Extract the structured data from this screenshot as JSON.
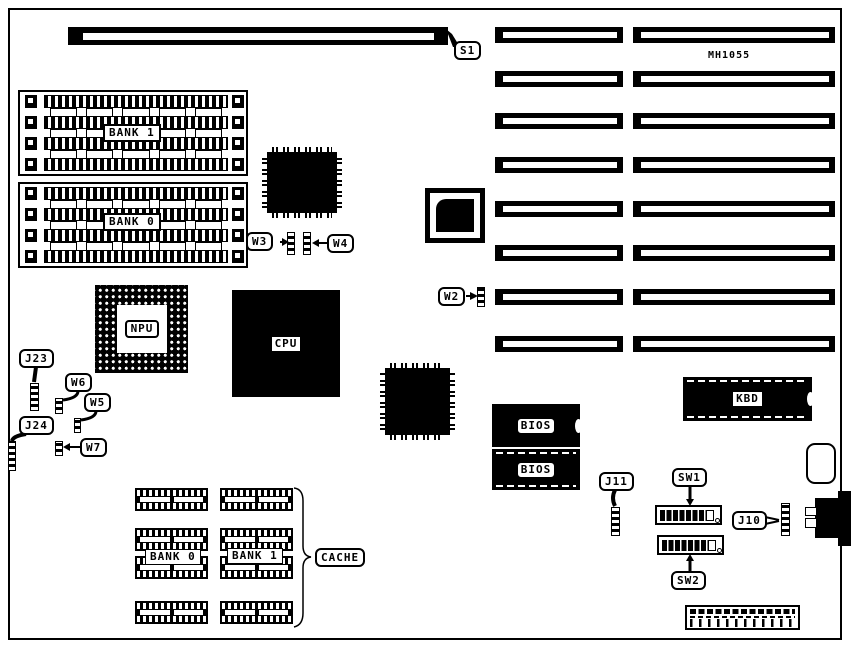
{
  "board": {
    "model_text": "MH1055",
    "type_note": "motherboard component location diagram"
  },
  "callouts": {
    "s1": {
      "label": "S1"
    },
    "w2": {
      "label": "W2"
    },
    "w3": {
      "label": "W3"
    },
    "w4": {
      "label": "W4"
    },
    "w5": {
      "label": "W5"
    },
    "w6": {
      "label": "W6"
    },
    "w7": {
      "label": "W7"
    },
    "j10": {
      "label": "J10"
    },
    "j11": {
      "label": "J11"
    },
    "j23": {
      "label": "J23"
    },
    "j24": {
      "label": "J24"
    },
    "sw1": {
      "label": "SW1"
    },
    "sw2": {
      "label": "SW2"
    },
    "cache": {
      "label": "CACHE"
    }
  },
  "chips": {
    "mem_bank1": {
      "label": "BANK 1"
    },
    "mem_bank0": {
      "label": "BANK 0"
    },
    "npu": {
      "label": "NPU"
    },
    "cpu": {
      "label": "CPU"
    },
    "bios_top": {
      "label": "BIOS"
    },
    "bios_bottom": {
      "label": "BIOS"
    },
    "kbd": {
      "label": "KBD"
    },
    "cache_bank0": {
      "label": "BANK 0"
    },
    "cache_bank1": {
      "label": "BANK 1"
    }
  },
  "expansion_slots": {
    "rows_y": [
      27,
      71,
      113,
      157,
      201,
      245,
      289,
      336
    ],
    "height": 16,
    "left_x": 495,
    "left_w": 128,
    "right_x": 633,
    "right_w": 202
  },
  "cache_sockets": {
    "cols_x": [
      135,
      220
    ],
    "rows_y": [
      488,
      528,
      556,
      601
    ],
    "width": 73,
    "height": 23
  },
  "memory_banks": {
    "comb_rows": 4,
    "chip_rows": 3,
    "chips_per_row": 5
  }
}
